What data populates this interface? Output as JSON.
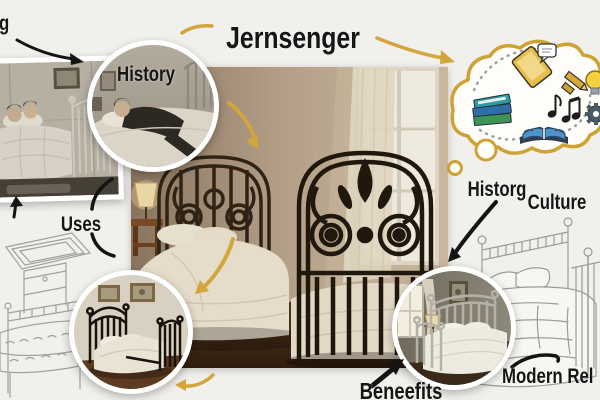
{
  "title": "Jernsenger",
  "labels": {
    "top_left_partial": "g",
    "history": "History",
    "uses": "Uses",
    "historg": "Historg",
    "culture": "Culture",
    "benefits": "Beneefits",
    "modern_relevance_partial": "Modern Rel"
  },
  "colors": {
    "background": "#f2f0ec",
    "gold_accent": "#d2a63c",
    "text": "#161616",
    "iron_dark": "#1c150c",
    "sketch_line": "#9d9d9d",
    "bubble_outline": "#cda333"
  },
  "thought_bubble": {
    "icon_names": [
      "stacked-books",
      "tablet-with-chat-bubble",
      "pencil",
      "lightbulb",
      "music-notes",
      "gear",
      "open-book"
    ]
  },
  "image_descriptions": {
    "center_photo": "ornate black wrought-iron bed in sunlit bedroom with window, sheer curtain, lamp and nightstand",
    "top_left_photo": "vintage sepia photo of two people lying in an iron bed",
    "history_circle_photo": "vintage photo of a dark-suited person resting on an iron bed",
    "bottom_left_circle_photo": "black iron bed with white bedding and two framed pictures",
    "bottom_right_circle_photo": "white iron bed with white duvet in a gray-walled bedroom",
    "left_sketch": "pencil line drawing of a bed with an over-bed table",
    "right_sketch": "pencil line drawing of an iron bed with pillows and duvet"
  }
}
